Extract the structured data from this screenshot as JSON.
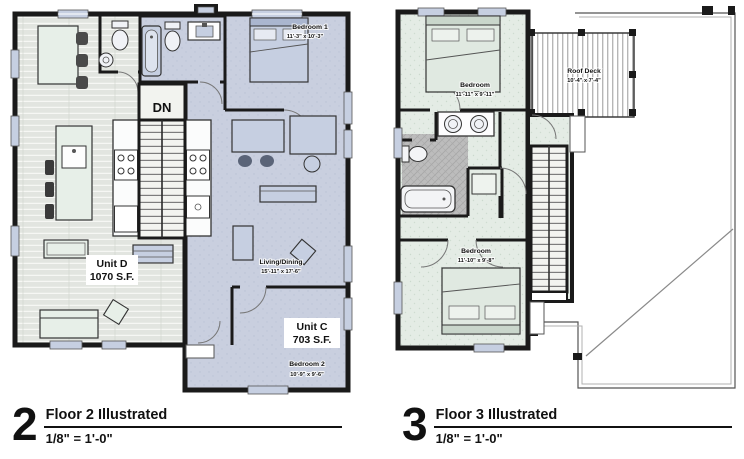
{
  "captions": {
    "floor2": {
      "number": "2",
      "title": "Floor 2 Illustrated",
      "scale": "1/8\" = 1'-0\""
    },
    "floor3": {
      "number": "3",
      "title": "Floor 3 Illustrated",
      "scale": "1/8\" = 1'-0\""
    }
  },
  "floor2": {
    "units": {
      "unit_d": {
        "name": "Unit D",
        "area": "1070 S.F."
      },
      "unit_c": {
        "name": "Unit C",
        "area": "703 S.F."
      }
    },
    "rooms": {
      "bedroom1": {
        "name": "Bedroom 1",
        "dims": "11'-3\" x 10'-3\""
      },
      "living_dining": {
        "name": "Living/Dining",
        "dims": "15'-11\" x 17'-6\""
      },
      "bedroom2": {
        "name": "Bedroom 2",
        "dims": "10'-9\" x 9'-6\""
      }
    },
    "stairs_label": "DN"
  },
  "floor3": {
    "rooms": {
      "bedroom_upper": {
        "name": "Bedroom",
        "dims": "11'-11\" x 9'-11\""
      },
      "roof_deck": {
        "name": "Roof Deck",
        "dims": "10'-4\" x 7'-4\""
      },
      "bedroom_lower": {
        "name": "Bedroom",
        "dims": "11'-10\" x 9'-8\""
      }
    }
  },
  "colors": {
    "wall": "#1a1a1a",
    "unit_d_floor": "#e2e5e0",
    "unit_c_floor": "#c9cfdf",
    "floor3_floor": "#e4ece5",
    "furniture_blue": "#c6cfe1",
    "furniture_mint": "#e7efe8",
    "tile": "#b8b8b8",
    "deck_line": "#8f8f8f"
  }
}
